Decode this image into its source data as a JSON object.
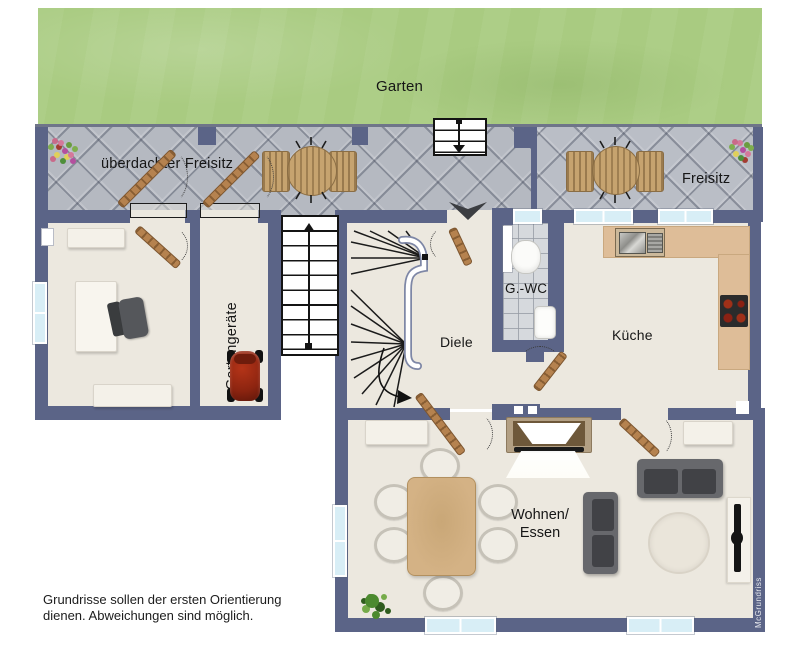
{
  "title": "Grundriss Erdgeschoss",
  "labels": {
    "garten": "Garten",
    "ueberdachter_freisitz": "überdachter Freisitz",
    "freisitz": "Freisitz",
    "gartengeraete": "Gartengeräte",
    "diele": "Diele",
    "gwc": "G.-WC",
    "kueche": "Küche",
    "wohnen": "Wohnen/",
    "essen": "Essen",
    "disclaimer_line1": "Grundrisse sollen der ersten Orientierung",
    "disclaimer_line2": "dienen. Abweichungen sind möglich.",
    "watermark": "McGrundriss"
  },
  "colors": {
    "wall": "#5b6487",
    "garden_green": "#a9cb81",
    "terrace_gray": "#b5b9c1",
    "room_floor": "#ece8df",
    "wc_tiles": "#d6d9dd",
    "kitchen_counter": "#debd98",
    "dining_table": "#d4b285",
    "door_wood": "#b5824f",
    "sofa_gray": "#67686c",
    "mower_red": "#9e2a12",
    "window_blue": "#d8eef6"
  },
  "rooms": [
    {
      "id": "garden",
      "label": "Garten"
    },
    {
      "id": "covered-terrace",
      "label": "überdachter Freisitz"
    },
    {
      "id": "open-terrace",
      "label": "Freisitz"
    },
    {
      "id": "garden-tools-room",
      "label": "Gartengeräte"
    },
    {
      "id": "hallway",
      "label": "Diele"
    },
    {
      "id": "guest-wc",
      "label": "G.-WC"
    },
    {
      "id": "kitchen",
      "label": "Küche"
    },
    {
      "id": "living-dining",
      "label": "Wohnen/Essen"
    }
  ]
}
